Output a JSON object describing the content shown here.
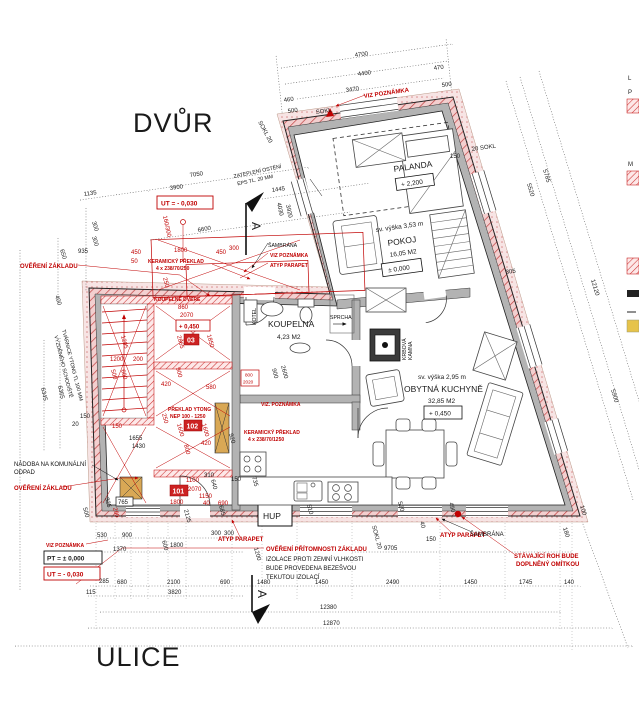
{
  "site": {
    "yard": "DVŮR",
    "street": "ULICE"
  },
  "rooms": {
    "palanda": {
      "name": "PALANDA",
      "level": "+ 2,200"
    },
    "pokoj": {
      "height": "sv. výška 3,53 m",
      "name": "POKOJ",
      "area": "16,05 M2",
      "level": "± 0,000"
    },
    "koupelna": {
      "name": "KOUPELNA",
      "area": "4,23 M2"
    },
    "sprcha": "SPRCHA",
    "kotel": "KOTEL",
    "krbova1": "KRBOVÁ",
    "krbova2": "KAMNA",
    "kuchyne": {
      "height": "sv. výška 2,95 m",
      "name": "OBYTNÁ KUCHYNĚ",
      "area": "32,85 M2",
      "level": "+ 0,450"
    },
    "hup": "HUP",
    "numbers": {
      "n101": "101",
      "n102": "102",
      "n103": "03"
    }
  },
  "levels": {
    "pt": "PT = ± 0,000",
    "ut_top": "UT = - 0,030",
    "ut_bottom": "UT = - 0,030",
    "plus450": "+ 0,450",
    "door_w": "800",
    "door_h": "2020"
  },
  "annotations_red": {
    "overeni_zakladu": "OVĚŘENÍ ZÁKLADU",
    "viz_poznamka": "VIZ POZNÁMKA",
    "viz_poznamka_dot": "VIZ. POZNÁMKA",
    "atyp_parapet": "ATYP PARAPET",
    "keramicky_preklad": "KERAMICKÝ PŘEKLAD",
    "keramicky_size1": "4 x 238/70/250",
    "keramicky_size2": "4 x 238/70/1250",
    "preklad_ytong": "PŘEKLAD YTONG",
    "preklad_ytong_size": "NEP 100 - 1250",
    "koupelne_dvere": "KOUPELNĚ DVEŘE",
    "stavajici_roh1": "STÁVAJÍCÍ ROH BUDE",
    "stavajici_roh2": "DOPLNĚNÝ OMÍTKOU",
    "overeni_pritomnosti": "OVĚŘENÍ PŘÍTOMNOSTI ZÁKLADU"
  },
  "annotations_black": {
    "sambrana": "ŠAMBRÁNA",
    "nadoba1": "NÁDOBA NA KOMUNÁLNÍ",
    "nadoba2": "ODPAD",
    "izolace1": "IZOLACE PROTI ZEMNÍ VLHKOSTI",
    "izolace2": "BUDE PROVEDENA BEZEŠVOU",
    "izolace3": "TEKUTOU IZOLACÍ",
    "zatepleni1": "ZATEPLENÍ OSTĚNÍ",
    "zatepleni2": "EPS TL. 20 MM",
    "tvarnice1": "TVÁRNICE YTONG TL 100 MM",
    "tvarnice2": "VYZDĚNÉHO SCHODIŠTĚ",
    "sokl": "SOKL",
    "sokl20": "SOKL 20",
    "sokl20b": "20 SOKL",
    "section": "A",
    "legendL": "L",
    "legendP": "P",
    "legendM": "M"
  },
  "dims": {
    "top": [
      "4700",
      "4400",
      "3470",
      "470",
      "500",
      "460",
      "500",
      "SOKL",
      "150",
      "20 SOKL",
      "SOKL 20"
    ],
    "left": [
      "7050",
      "1135",
      "3900",
      "6600",
      "1445",
      "935",
      "650",
      "300",
      "300",
      "400",
      "6345",
      "6365",
      "150",
      "20",
      "4030",
      "3920"
    ],
    "right": [
      "5785",
      "5520",
      "12120",
      "305",
      "5900"
    ],
    "bottom": [
      "530",
      "900",
      "300",
      "300",
      "1370",
      "1800",
      "600",
      "1200",
      "285",
      "680",
      "2100",
      "690",
      "1480",
      "3820",
      "115",
      "1450",
      "2490",
      "1450",
      "1745",
      "140",
      "12380",
      "12870",
      "9705",
      "SOKL 20",
      "150",
      "490",
      "520",
      "510",
      "735",
      "150",
      "180",
      "100",
      "40",
      "500",
      "325",
      "765",
      "200",
      "640",
      "310",
      "685",
      "2125"
    ],
    "inner": [
      "1800",
      "450",
      "450",
      "300",
      "50",
      "250",
      "860",
      "2070",
      "2865",
      "1850",
      "2600",
      "900",
      "1295",
      "1200",
      "200",
      "500",
      "600",
      "900",
      "580",
      "420",
      "1655",
      "1430",
      "150",
      "250",
      "1600",
      "1600",
      "420",
      "800",
      "1100",
      "2070",
      "1150",
      "1800",
      "40",
      "690",
      "920",
      "800",
      "2020",
      "160/300"
    ]
  },
  "colors": {
    "annotation_red": "#c00000",
    "wall_gray": "#b3b3b3",
    "hatch_pink": "#f3cfcf",
    "tan": "#d9a855"
  }
}
